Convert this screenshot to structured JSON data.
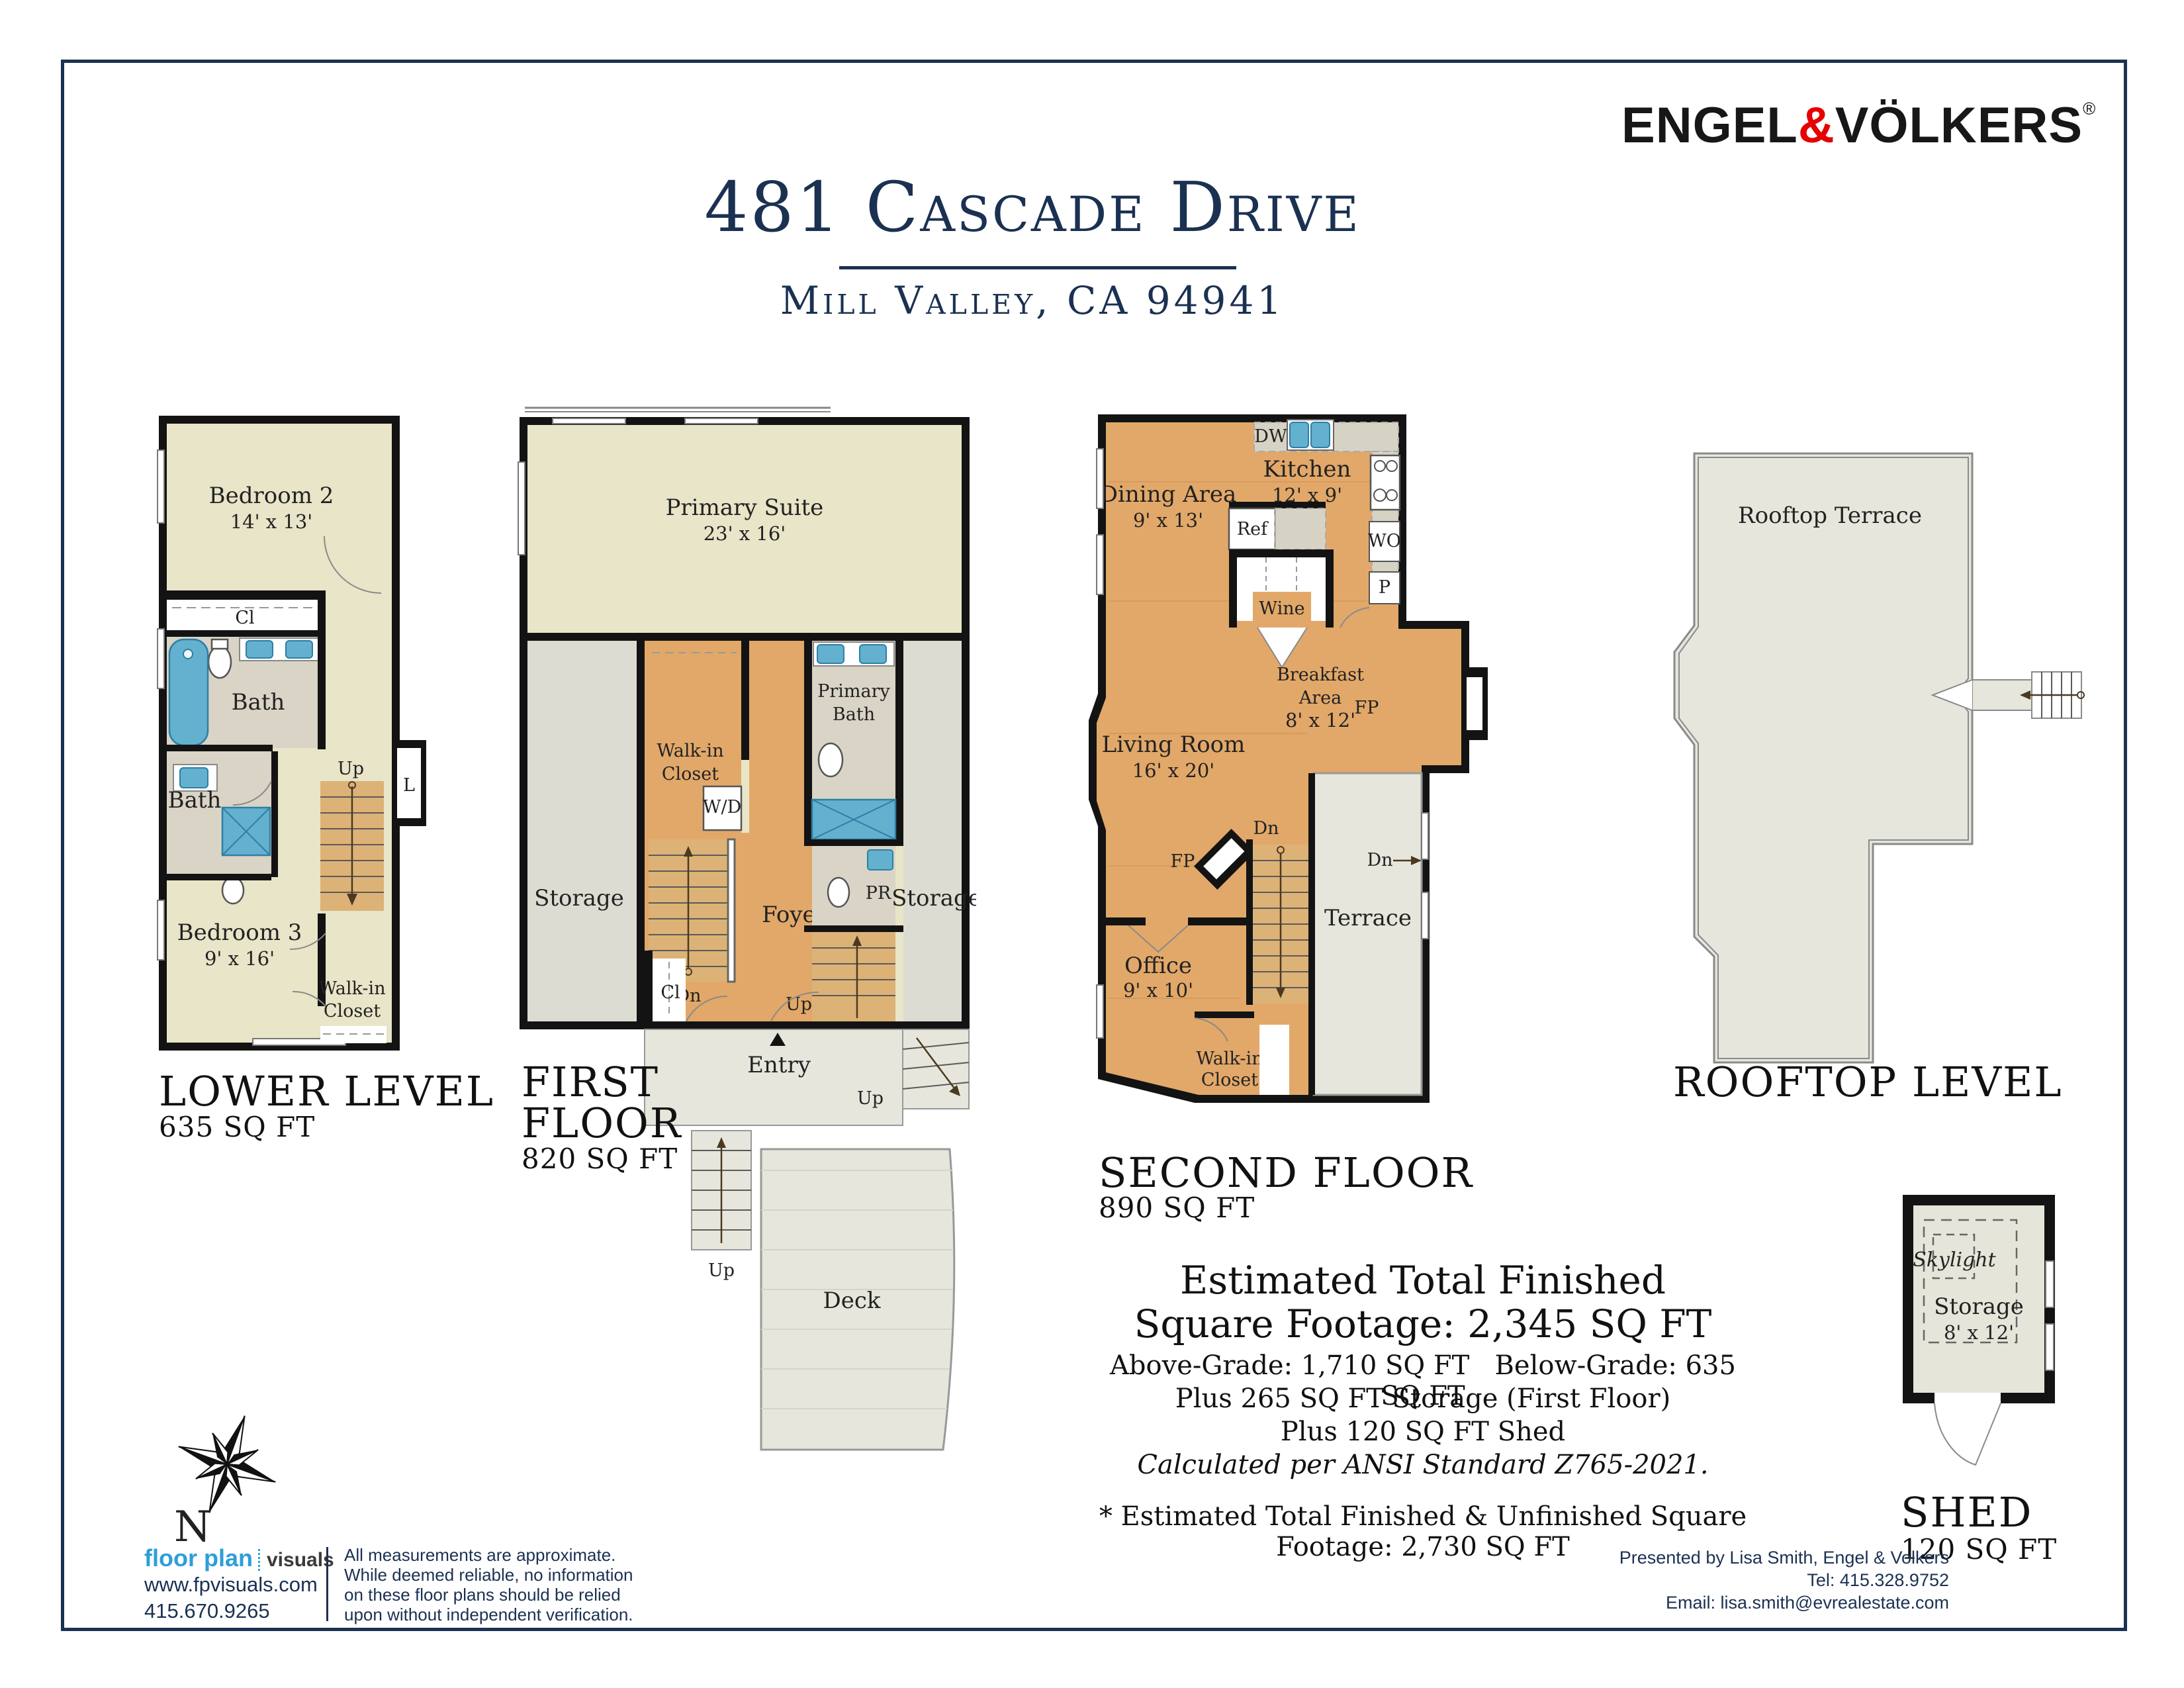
{
  "colors": {
    "navy": "#1b3152",
    "ev_red": "#e60000",
    "beige": "#e8e5c8",
    "wood": "#e2a869",
    "gray": "#e3e3da",
    "tile": "#d9d4c6",
    "fixture_blue": "#64b1cf",
    "wall": "#131313"
  },
  "brand": {
    "logo_left": "ENGEL",
    "logo_amp": "&",
    "logo_right": "VÖLKERS",
    "registered": "®"
  },
  "header": {
    "title": "481 Cascade Drive",
    "subtitle": "Mill Valley, CA 94941"
  },
  "floors": {
    "lower": {
      "title": "LOWER LEVEL",
      "sqft": "635 SQ FT",
      "labels": {
        "bedroom2": "Bedroom 2",
        "bedroom2_dim": "14' x 13'",
        "cl": "Cl",
        "bath1": "Bath",
        "bath2": "Bath",
        "laundry": "L",
        "up": "Up",
        "bedroom3": "Bedroom 3",
        "bedroom3_dim": "9' x 16'",
        "wic1": "Walk-in",
        "wic2": "Closet"
      }
    },
    "first": {
      "title1": "FIRST",
      "title2": "FLOOR",
      "sqft": "820 SQ FT",
      "labels": {
        "primary_suite": "Primary Suite",
        "primary_suite_dim": "23' x 16'",
        "storage_left": "Storage",
        "storage_right": "Storage",
        "wic1": "Walk-in",
        "wic2": "Closet",
        "wd": "W/D",
        "primary_bath1": "Primary",
        "primary_bath2": "Bath",
        "pr": "PR",
        "foyer": "Foyer",
        "dn": "Dn",
        "up_inner": "Up",
        "cl": "Cl",
        "entry": "Entry",
        "up_porch": "Up",
        "up_deck": "Up",
        "deck": "Deck"
      }
    },
    "second": {
      "title": "SECOND FLOOR",
      "sqft": "890 SQ FT",
      "labels": {
        "dw": "DW",
        "kitchen": "Kitchen",
        "kitchen_dim": "12' x 9'",
        "dining": "Dining Area",
        "dining_dim": "9' x 13'",
        "ref": "Ref",
        "wine": "Wine",
        "wo": "WO",
        "p": "P",
        "breakfast1": "Breakfast",
        "breakfast2": "Area",
        "breakfast_dim": "8' x 12'",
        "fp_right": "FP",
        "living": "Living Room",
        "living_dim": "16' x 20'",
        "fp_left": "FP",
        "dn_stairs": "Dn",
        "dn_terrace": "Dn",
        "terrace": "Terrace",
        "office": "Office",
        "office_dim": "9' x 10'",
        "wic1": "Walk-in",
        "wic2": "Closet"
      }
    },
    "rooftop": {
      "title": "ROOFTOP LEVEL",
      "labels": {
        "terrace": "Rooftop Terrace"
      }
    },
    "shed": {
      "title": "SHED",
      "sqft": "120 SQ FT",
      "labels": {
        "skylight": "Skylight",
        "storage": "Storage",
        "storage_dim": "8' x 12'"
      }
    }
  },
  "summary": {
    "line1": "Estimated Total Finished",
    "line2": "Square Footage: 2,345 SQ FT",
    "line3a": "Above-Grade: 1,710 SQ FT",
    "line3b": "Below-Grade: 635 SQ FT",
    "line4": "Plus 265 SQ FT Storage (First Floor)",
    "line5": "Plus 120 SQ FT Shed",
    "line6": "Calculated per ANSI Standard Z765-2021.",
    "line7": "* Estimated Total Finished & Unfinished Square Footage: 2,730 SQ FT"
  },
  "compass": {
    "north": "N"
  },
  "footer": {
    "fp_logo_bold": "floor plan",
    "fp_logo_light": "visuals",
    "fp_url": "www.fpvisuals.com",
    "fp_phone": "415.670.9265",
    "disclaimer1": "All measurements are approximate.",
    "disclaimer2": "While deemed reliable, no information",
    "disclaimer3": "on these floor plans should be relied",
    "disclaimer4": "upon without independent verification.",
    "presented": "Presented by Lisa Smith, Engel & Volkers",
    "tel": "Tel: 415.328.9752",
    "email": "Email: lisa.smith@evrealestate.com"
  }
}
